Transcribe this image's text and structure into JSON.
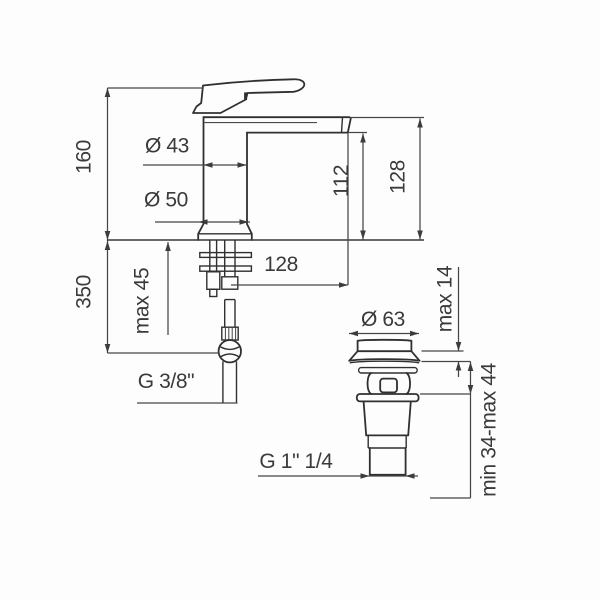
{
  "drawing_type": "technical-dimension-drawing",
  "colors": {
    "background": "#fdfdfd",
    "outline": "#303030",
    "dimension": "#464646",
    "text": "#3a3a3a"
  },
  "faucet_dims": {
    "height_above_deck": "160",
    "reach_below_deck": "350",
    "max_deck_thickness": "max 45",
    "top_diameter": "Ø 43",
    "base_diameter": "Ø 50",
    "spout_outlet_height": "112",
    "spout_top_height": "128",
    "spout_reach": "128",
    "supply_thread": "G 3/8\""
  },
  "waste_dims": {
    "cap_diameter": "Ø 63",
    "cap_height": "max 14",
    "clamp_range": "min 34-max 44",
    "outlet_thread": "G 1\" 1/4"
  }
}
